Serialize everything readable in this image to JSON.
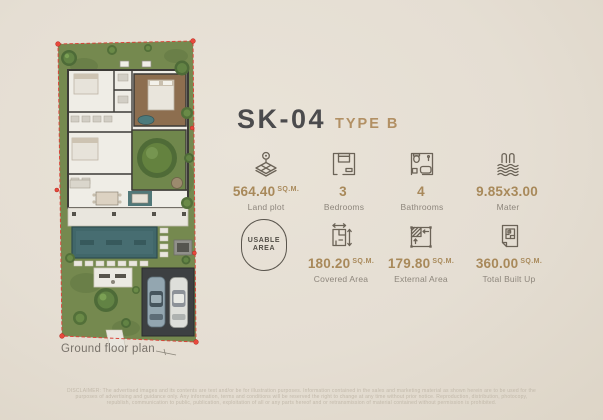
{
  "header": {
    "model": "SK-04",
    "type": "TYPE B"
  },
  "specs_row1": [
    {
      "icon": "land-plot-icon",
      "value": "564.40",
      "unit": "SQ.M.",
      "label": "Land plot"
    },
    {
      "icon": "bedrooms-icon",
      "value": "3",
      "unit": "",
      "label": "Bedrooms"
    },
    {
      "icon": "bathrooms-icon",
      "value": "4",
      "unit": "",
      "label": "Bathrooms"
    },
    {
      "icon": "pool-icon",
      "value": "9.85x3.00",
      "unit": "",
      "label": "Mater"
    }
  ],
  "usable_area_badge": {
    "line1": "USABLE",
    "line2": "AREA"
  },
  "specs_row2": [
    {
      "icon": "covered-area-icon",
      "value": "180.20",
      "unit": "SQ.M.",
      "label": "Covered Area"
    },
    {
      "icon": "external-area-icon",
      "value": "179.80",
      "unit": "SQ.M.",
      "label": "External Area"
    },
    {
      "icon": "total-built-up-icon",
      "value": "360.00",
      "unit": "SQ.M.",
      "label": "Total Built Up"
    }
  ],
  "floor_plan": {
    "caption": "Ground floor plan"
  },
  "disclaimer": {
    "line1": "DISCLAIMER: The advertised images and its contents are text and/or be for illustration purposes. Information contained in the sales and marketing material as shown herein are to be used for the",
    "line2": "purposes of advertising and guidance only. Any information, terms and conditions will be reserved the right to change at any time without prior notice. Reproduction, distribution, photocopy,",
    "line3": "republish, communication to public, publication, exploitation of all or any parts hereof and or retransmission of material contained without permission is prohibited."
  },
  "colors": {
    "accent_gold": "#a8895a",
    "title_dark": "#4b4b4d",
    "type_tan": "#b29064",
    "label_gray": "#8d867c",
    "icon_stroke": "#6b6357",
    "boundary_red": "#d8453a",
    "pool_teal": "#41676a",
    "lawn_green": "#75894f",
    "background": "#e5ded3"
  }
}
